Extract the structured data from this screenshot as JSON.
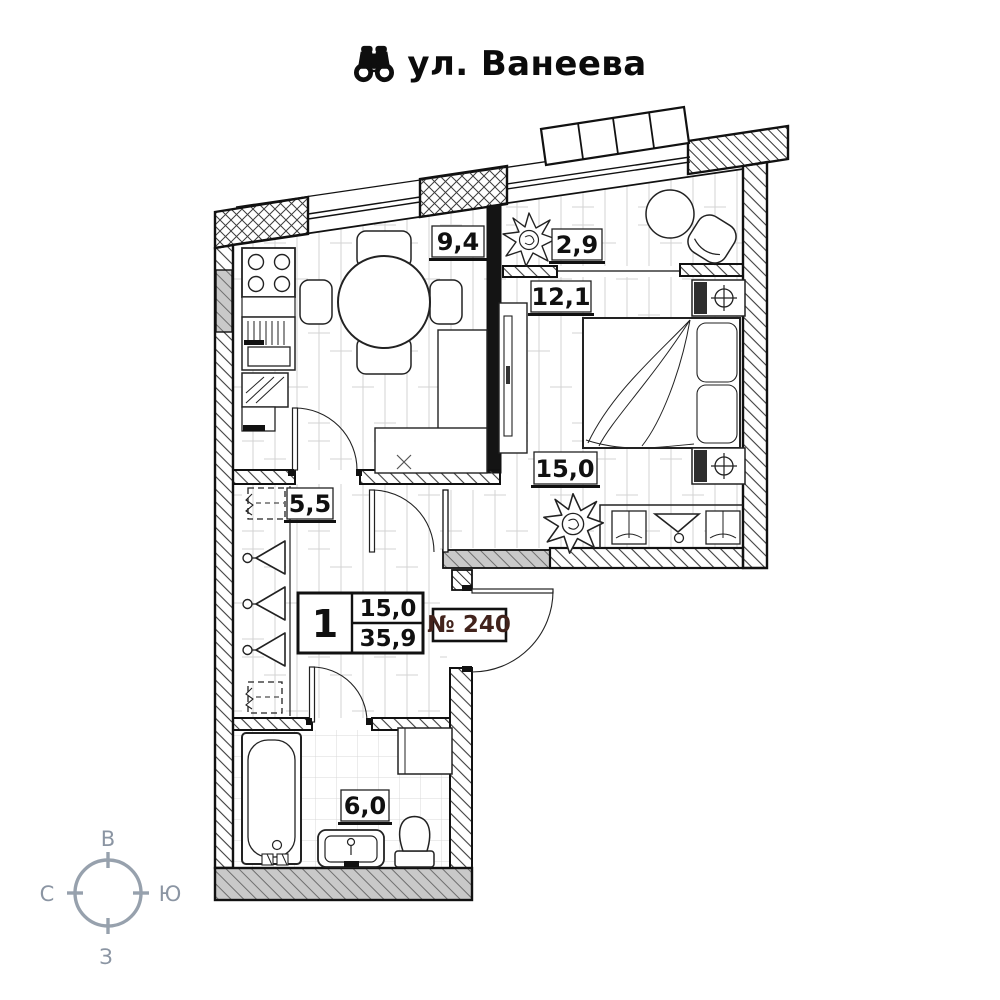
{
  "title": {
    "street": "ул. Ванеева",
    "icon": "binoculars-icon"
  },
  "apartment": {
    "door_number": "№ 240",
    "rooms_count": "1",
    "living_area": "15,0",
    "total_area": "35,9"
  },
  "rooms": [
    {
      "name": "kitchen",
      "area": "9,4"
    },
    {
      "name": "loggia",
      "area": "2,9"
    },
    {
      "name": "bedroom",
      "area": "12,1"
    },
    {
      "name": "living-room",
      "area": "15,0"
    },
    {
      "name": "hallway",
      "area": "5,5"
    },
    {
      "name": "bathroom",
      "area": "6,0"
    }
  ],
  "compass": {
    "top": "В",
    "left": "С",
    "right": "Ю",
    "bottom": "З"
  },
  "colors": {
    "door_number_text": "#42231c",
    "compass": "#8b95a3",
    "wall": "#111111"
  }
}
